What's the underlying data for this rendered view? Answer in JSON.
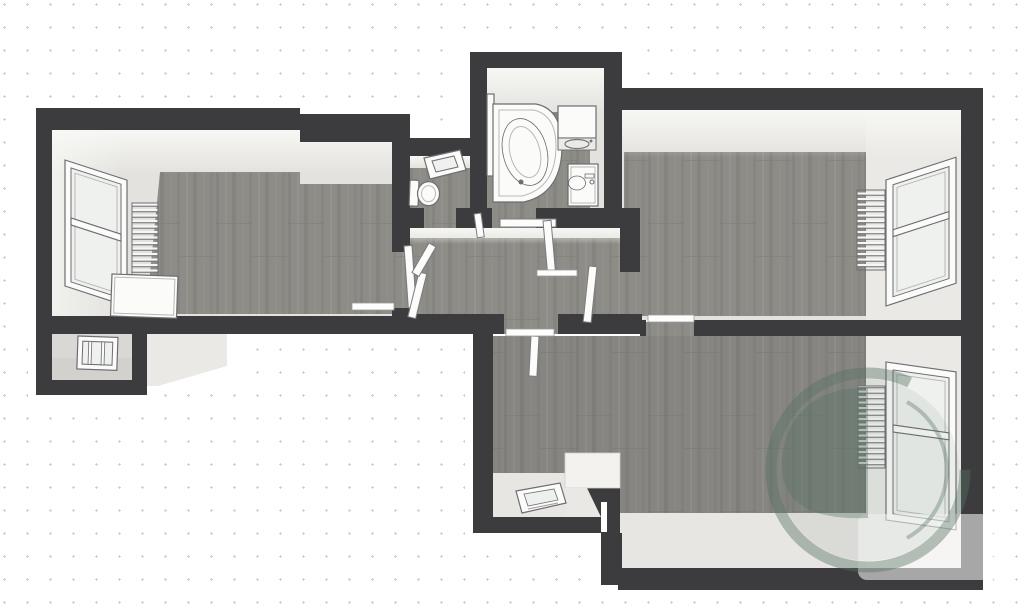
{
  "scene": {
    "type": "3d-floorplan-top-down-render",
    "background": {
      "style": "dotted-grid",
      "dot_spacing_px": 23
    },
    "colors": {
      "wall": "#3c3c3e",
      "floor": "#e3e2de",
      "face": "#eae9e5",
      "face-deep": "#e7e6e2",
      "fixture": "#fbfbf9",
      "line": "#6d6d73",
      "glass": "#eff1ee",
      "dot": "#d2d2d0",
      "ceiling": "#f8f8f5",
      "brand": "#567164"
    },
    "watermark": {
      "name": "g-leaf-logo",
      "color": "#567164",
      "opacity": 0.42,
      "card_opacity": 0.55
    },
    "rooms": [
      {
        "name": "room-left",
        "features": [
          "window",
          "radiator",
          "leaning-panel",
          "threshold"
        ]
      },
      {
        "name": "wc",
        "features": [
          "toilet",
          "wall-mirror"
        ]
      },
      {
        "name": "bathroom",
        "features": [
          "corner-bathtub",
          "shower-screen",
          "washing-machine",
          "sink-cabinet"
        ]
      },
      {
        "name": "hallway",
        "features": [
          "open-doors",
          "doormat"
        ]
      },
      {
        "name": "room-right-top",
        "features": [
          "window",
          "radiator",
          "threshold"
        ]
      },
      {
        "name": "room-bottom",
        "features": [
          "window",
          "radiator",
          "floor-hatch",
          "entry-step",
          "door-slit"
        ]
      },
      {
        "name": "balcony-alcove",
        "features": [
          "small-window"
        ]
      }
    ]
  }
}
